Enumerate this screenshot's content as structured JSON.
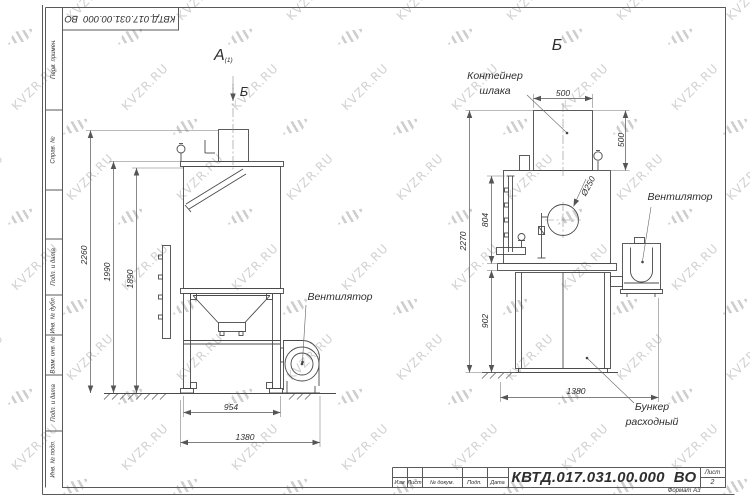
{
  "watermark": {
    "text": "KVZR.RU"
  },
  "frame": {
    "top_doc_number": "КВТД.017.031.00.000  ВО",
    "side_fields": [
      "Перв. примен.",
      "Справ. №",
      "Подп. и дата",
      "Инв. № дубл.",
      "Взам. инв. №",
      "Подп. и дата",
      "Инв. № подл."
    ]
  },
  "title_block": {
    "doc_number": "КВТД.017.031.00.000  ВО",
    "sheet_label": "Лист",
    "sheet_number": "2",
    "format_label": "Формат А3",
    "columns": [
      "Изм",
      "Лист",
      "№ докум.",
      "Подп.",
      "Дата"
    ]
  },
  "left_view": {
    "label": "А",
    "label_sub": "(1)",
    "section_label": "Б",
    "fan_callout": "Вентилятор",
    "dim_2260": "2260",
    "dim_1990": "1990",
    "dim_1890": "1890",
    "dim_954": "954",
    "dim_1380": "1380"
  },
  "right_view": {
    "label": "Б",
    "container_callout_line1": "Контейнер",
    "container_callout_line2": "шлака",
    "fan_callout": "Вентилятор",
    "bunker_callout_line1": "Бункер",
    "bunker_callout_line2": "расходный",
    "dim_top_500": "500",
    "dim_side_500": "500",
    "dim_hole": "Ø250",
    "dim_2270": "2270",
    "dim_804": "804",
    "dim_902": "902",
    "dim_1380": "1380"
  }
}
